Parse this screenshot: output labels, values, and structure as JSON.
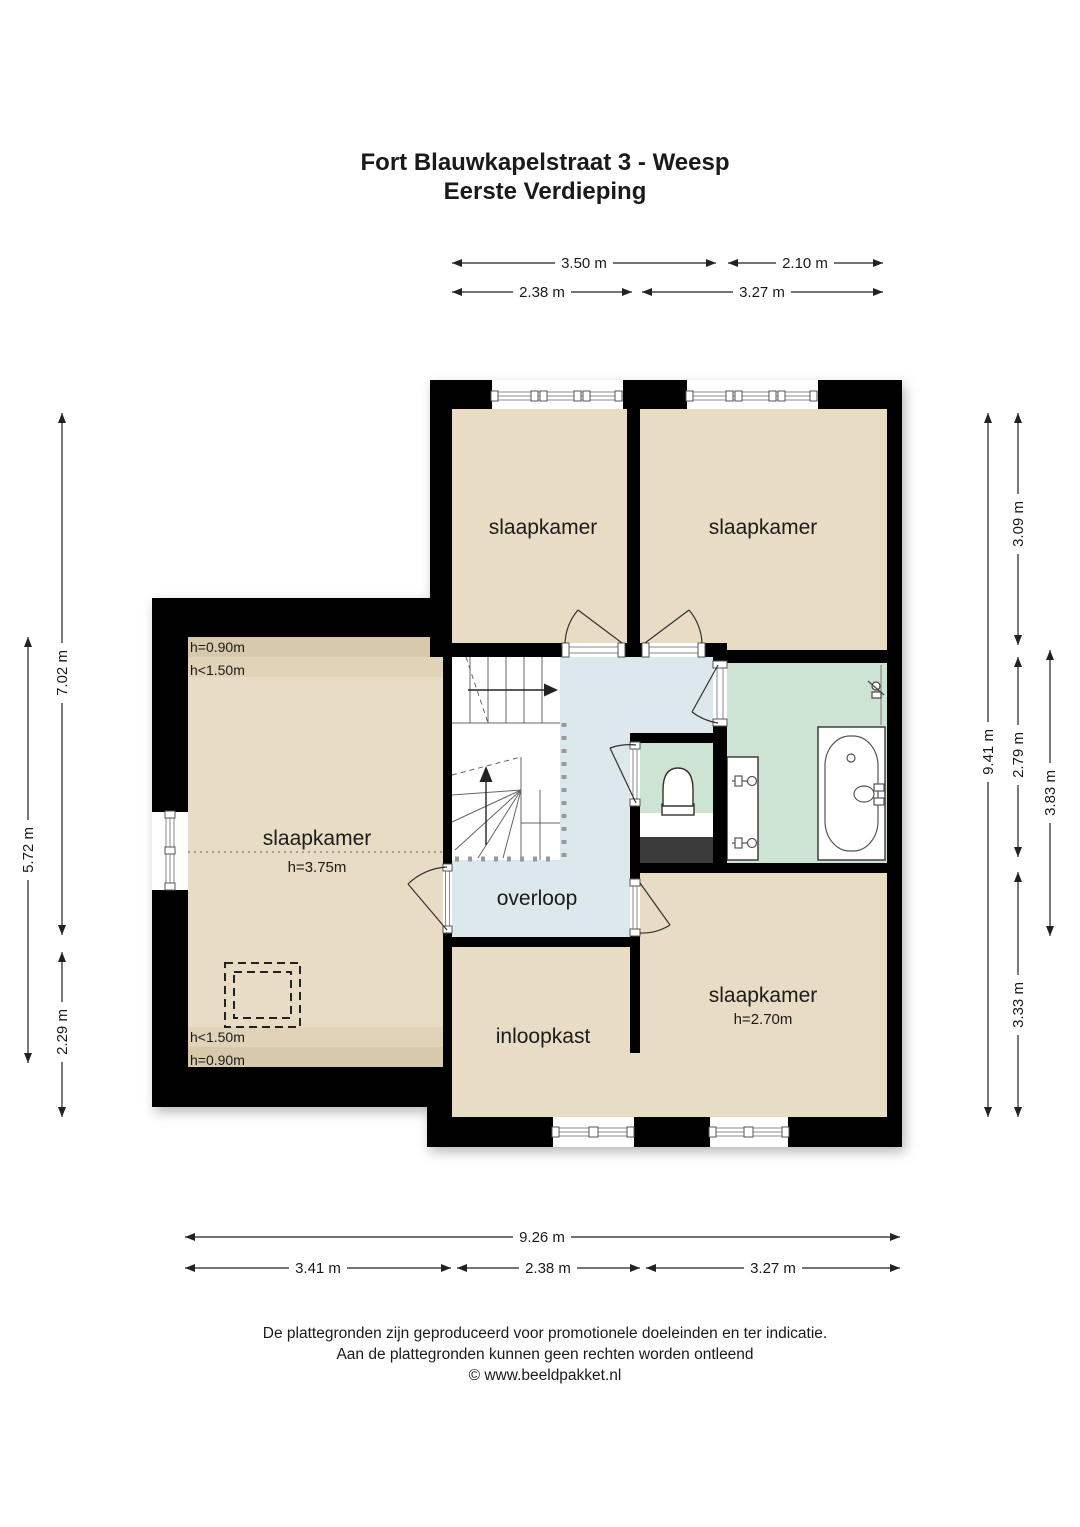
{
  "title": {
    "line1": "Fort Blauwkapelstraat 3 - Weesp",
    "line2": "Eerste Verdieping"
  },
  "rooms": {
    "bedroom_top_left": {
      "label": "slaapkamer"
    },
    "bedroom_top_right": {
      "label": "slaapkamer"
    },
    "bedroom_left": {
      "label": "slaapkamer",
      "height": "h=3.75m",
      "edge_top_1": "h=0.90m",
      "edge_top_2": "h<1.50m",
      "edge_bottom_1": "h<1.50m",
      "edge_bottom_2": "h=0.90m"
    },
    "bedroom_bottom": {
      "label": "slaapkamer",
      "height": "h=2.70m"
    },
    "landing": {
      "label": "overloop"
    },
    "closet": {
      "label": "inloopkast"
    }
  },
  "dimensions": {
    "top_row1": [
      {
        "label": "3.50 m"
      },
      {
        "label": "2.10 m"
      }
    ],
    "top_row2": [
      {
        "label": "2.38 m"
      },
      {
        "label": "3.27 m"
      }
    ],
    "bottom_row1": [
      {
        "label": "9.26 m"
      }
    ],
    "bottom_row2": [
      {
        "label": "3.41 m"
      },
      {
        "label": "2.38 m"
      },
      {
        "label": "3.27 m"
      }
    ],
    "left": [
      {
        "label": "7.02 m"
      },
      {
        "label": "5.72 m"
      },
      {
        "label": "2.29 m"
      }
    ],
    "right": [
      {
        "label": "9.41 m"
      },
      {
        "label": "3.09 m"
      },
      {
        "label": "2.79 m"
      },
      {
        "label": "3.33 m"
      },
      {
        "label": "3.83 m"
      }
    ]
  },
  "footer": {
    "line1": "De plattegronden zijn geproduceerd voor promotionele doeleinden en ter indicatie.",
    "line2": "Aan de plattegronden kunnen geen rechten worden ontleend",
    "line3": "© www.beeldpakket.nl"
  },
  "colors": {
    "wall": "#000000",
    "room_tan": "#e8dcc4",
    "room_tan_mid": "#e0d3b8",
    "room_tan_dark": "#d7c9ab",
    "landing_blue": "#dce8eb",
    "bath_green": "#cde4d2",
    "void_dark": "#3a3a3a"
  }
}
